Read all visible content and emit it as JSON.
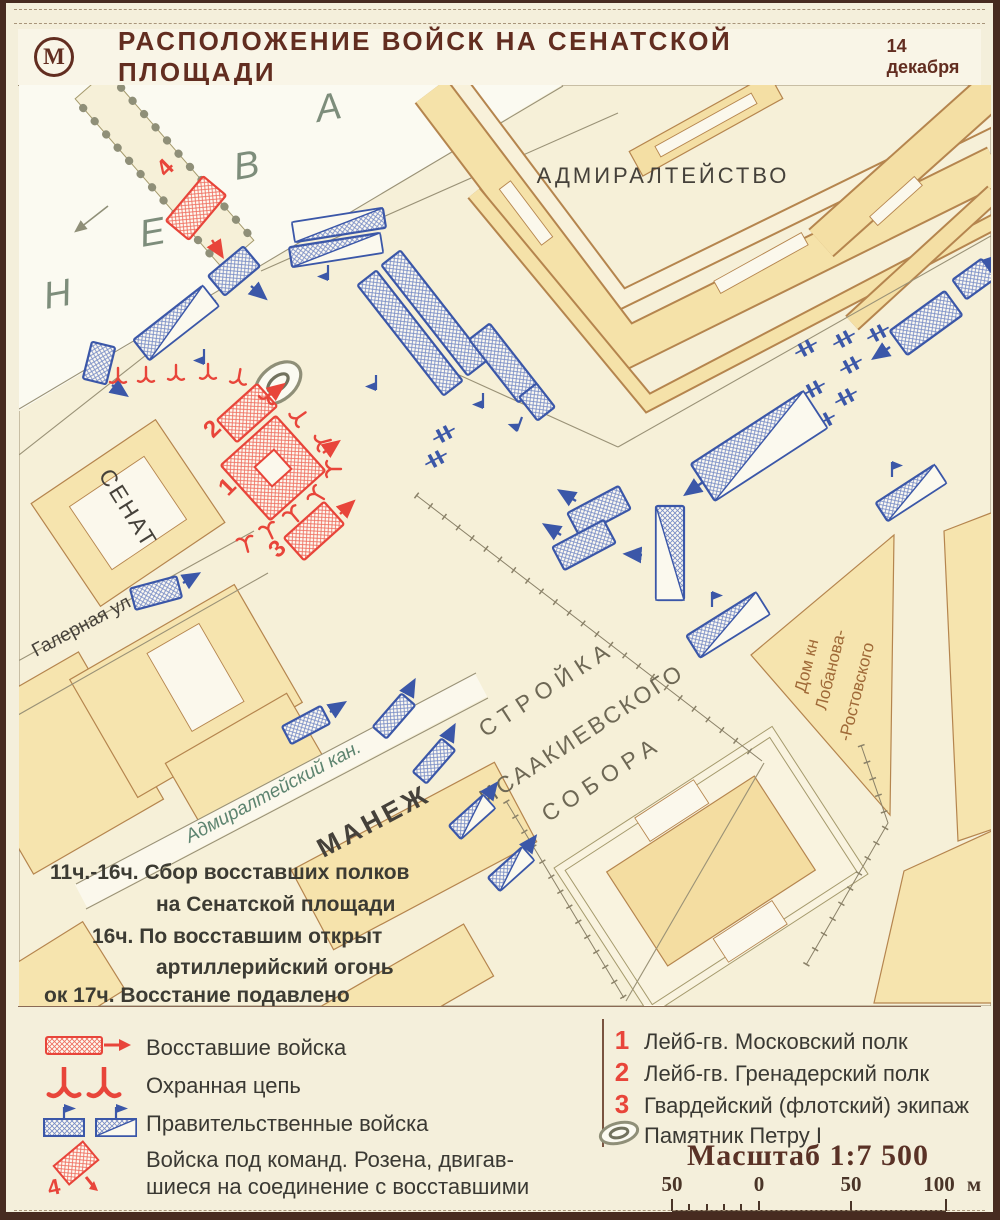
{
  "title": {
    "logo_letter": "М",
    "main": "РАСПОЛОЖЕНИЕ ВОЙСК НА СЕНАТСКОЙ ПЛОЩАДИ",
    "date": "14 декабря"
  },
  "map": {
    "labels": {
      "admiralty": "АДМИРАЛТЕЙСТВО",
      "senate": "СЕНАТ",
      "manege": "МАНЕЖ",
      "galernaya": "Галерная ул.",
      "canal": "Адмиралтейский кан.",
      "stroyka_line1": "СТРОЙКА",
      "stroyka_line2": "ИСААКИЕВСКОГО",
      "stroyka_line3": "СОБОРА",
      "lobanov_line1": "Дом кн",
      "lobanov_line2": "Лобанова-",
      "lobanov_line3": "-Ростовского"
    },
    "river_letters": [
      "Н",
      "Е",
      "В",
      "А"
    ],
    "unit_numbers": {
      "n1": "1",
      "n2": "2",
      "n3": "3",
      "n4": "4"
    },
    "timeline": [
      "11ч.-16ч. Сбор восставших полков",
      "на Сенатской площади",
      "16ч. По восставшим открыт",
      "артиллерийский огонь",
      "ок 17ч. Восстание подавлено"
    ]
  },
  "legend": {
    "rebel": "Восставшие войска",
    "chain": "Охранная цепь",
    "government": "Правительственные войска",
    "rosen_line1": "Войска под команд. Розена, двигав-",
    "rosen_line2": "шиеся на соединение с восставшими",
    "rosen_num": "4",
    "units": [
      {
        "num": "1",
        "label": "Лейб-гв. Московский полк"
      },
      {
        "num": "2",
        "label": "Лейб-гв. Гренадерский полк"
      },
      {
        "num": "3",
        "label": "Гвардейский (флотский) экипаж"
      }
    ],
    "monument": "Памятник Петру I",
    "scale_title": "Масштаб 1:7 500",
    "scale_ticks": [
      "50",
      "0",
      "50",
      "100"
    ],
    "scale_unit": "м"
  },
  "colors": {
    "rebel_red": "#e8453a",
    "government_blue": "#3b57a8",
    "building_fill": "#f6e4ae",
    "river": "#fbfaf1",
    "paper": "#f4efdb",
    "ink": "#622d20"
  }
}
